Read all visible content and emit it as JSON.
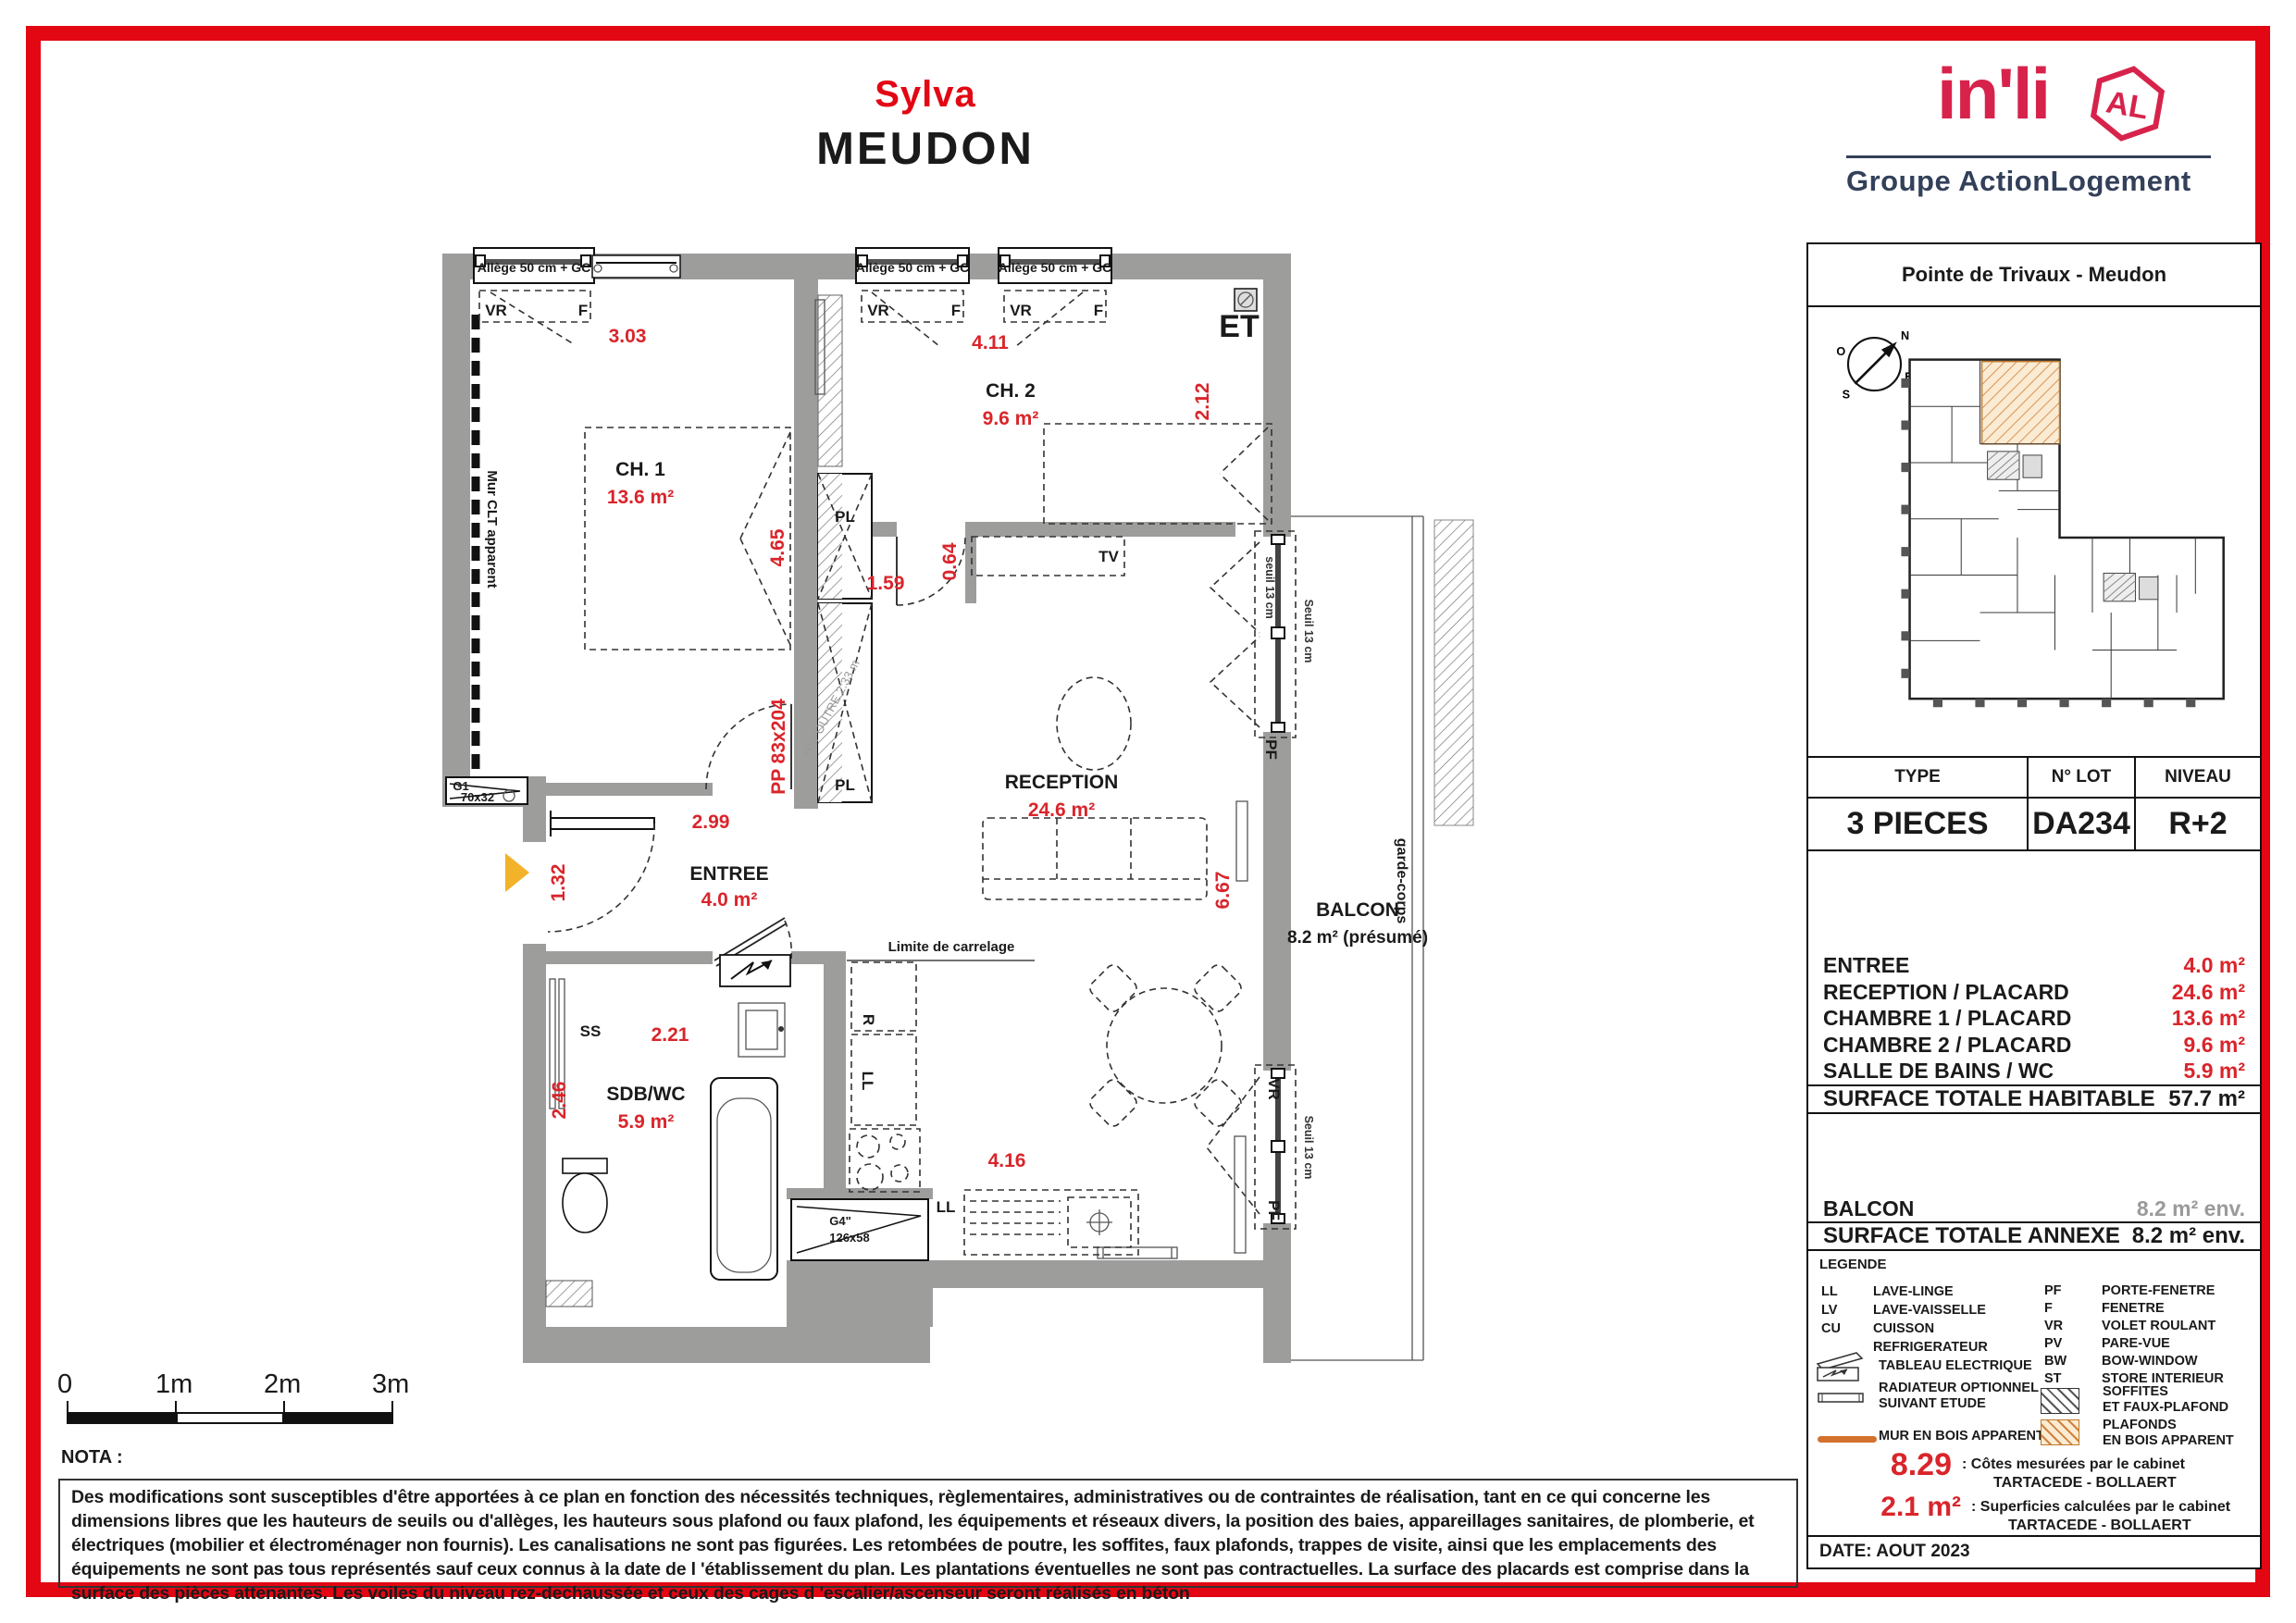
{
  "colors": {
    "frame_red": "#E30613",
    "accent_red": "#D9252B",
    "wall_gray": "#9D9D9C",
    "brand_red": "#D7234B",
    "brand_navy": "#33405A",
    "legend_orange": "#D2722E",
    "balcony_gray": "#8a8a8a",
    "entrance_yellow": "#F2B229"
  },
  "header": {
    "project": "Sylva",
    "city": "MEUDON"
  },
  "logo": {
    "brand": "in'li",
    "badge": "AL",
    "group": "Groupe ActionLogement"
  },
  "panel": {
    "project": "Pointe de Trivaux - Meudon",
    "compass": {
      "n": "N",
      "s": "S",
      "e": "E",
      "o": "O"
    },
    "lot_table": {
      "type_label": "TYPE",
      "type_value": "3 PIECES",
      "lot_label": "N° LOT",
      "lot_value": "DA234",
      "niveau_label": "NIVEAU",
      "niveau_value": "R+2"
    },
    "rooms": [
      {
        "label": "ENTREE",
        "value": "4.0 m²"
      },
      {
        "label": "RECEPTION / PLACARD",
        "value": "24.6 m²"
      },
      {
        "label": "CHAMBRE 1 / PLACARD",
        "value": "13.6 m²"
      },
      {
        "label": "CHAMBRE 2 / PLACARD",
        "value": "9.6 m²"
      },
      {
        "label": "SALLE DE BAINS / WC",
        "value": "5.9 m²"
      }
    ],
    "total": {
      "label": "SURFACE TOTALE HABITABLE",
      "value": "57.7 m²"
    },
    "balcon": {
      "label": "BALCON",
      "value": "8.2 m² env."
    },
    "annexe": {
      "label": "SURFACE TOTALE ANNEXE",
      "value": "8.2 m² env."
    },
    "legend": {
      "title": "LEGENDE",
      "col1": [
        {
          "abbr": "LL",
          "label": "LAVE-LINGE"
        },
        {
          "abbr": "LV",
          "label": "LAVE-VAISSELLE"
        },
        {
          "abbr": "CU",
          "label": "CUISSON"
        },
        {
          "abbr": "",
          "label": "REFRIGERATEUR"
        }
      ],
      "col2": [
        {
          "abbr": "PF",
          "label": "PORTE-FENETRE"
        },
        {
          "abbr": "F",
          "label": "FENETRE"
        },
        {
          "abbr": "VR",
          "label": "VOLET ROULANT"
        },
        {
          "abbr": "PV",
          "label": "PARE-VUE"
        },
        {
          "abbr": "BW",
          "label": "BOW-WINDOW"
        },
        {
          "abbr": "ST",
          "label": "STORE INTERIEUR"
        }
      ],
      "tableau": "TABLEAU ELECTRIQUE",
      "radiateur_1": "RADIATEUR OPTIONNEL",
      "radiateur_2": "SUIVANT ETUDE",
      "soffites_1": "SOFFITES",
      "soffites_2": "ET FAUX-PLAFOND",
      "mur_bois": "MUR EN BOIS APPARENT",
      "plafonds_1": "PLAFONDS",
      "plafonds_2": "EN BOIS APPARENT",
      "cotes_value": "8.29",
      "cotes_text": ": Côtes mesurées par le cabinet",
      "cotes_cabinet": "TARTACEDE - BOLLAERT",
      "sup_value": "2.1 m²",
      "sup_text": ": Superficies calculées par le cabinet",
      "sup_cabinet": "TARTACEDE - BOLLAERT"
    },
    "date": "DATE: AOUT 2023"
  },
  "plan": {
    "rooms": {
      "ch1": {
        "name": "CH. 1",
        "area": "13.6 m²"
      },
      "ch2": {
        "name": "CH. 2",
        "area": "9.6 m²"
      },
      "reception": {
        "name": "RECEPTION",
        "area": "24.6 m²"
      },
      "entree": {
        "name": "ENTREE",
        "area": "4.0 m²"
      },
      "sdb": {
        "name": "SDB/WC",
        "area": "5.9 m²"
      },
      "balcon": {
        "name": "BALCON",
        "area": "8.2 m² (présumé)"
      }
    },
    "dims": {
      "d303": "3.03",
      "d411": "4.11",
      "d212": "2.12",
      "d465": "4.65",
      "d159": "1.59",
      "d064": "0.64",
      "d299": "2.99",
      "d132": "1.32",
      "d221": "2.21",
      "d246": "2.46",
      "d416": "4.16",
      "d667": "6.67"
    },
    "labels": {
      "allege": "Allège 50 cm + GC",
      "vr": "VR",
      "f": "F",
      "pf": "PF",
      "pl": "PL",
      "tv": "TV",
      "ss": "SS",
      "r": "R",
      "ll": "LL",
      "mur_clt": "Mur CLT apparent",
      "pp": "PP 83x204",
      "hspoutre": "HSPOUTRE 2.33 m",
      "limite": "Limite de carrelage",
      "garde_corps": "garde-corps",
      "seuil": "Seuil 13 cm",
      "seuil_lc": "seuil 13 cm",
      "g1": "G1",
      "g1_size": "70x32",
      "g4": "G4\"",
      "g4_size": "126x58",
      "et": "ET"
    }
  },
  "scalebar": {
    "t0": "0",
    "t1": "1m",
    "t2": "2m",
    "t3": "3m"
  },
  "nota": {
    "label": "NOTA :",
    "text": "Des modifications sont susceptibles d'être apportées à ce plan en fonction des nécessités techniques, règlementaires, administratives ou de contraintes de réalisation, tant en ce qui concerne les dimensions libres que les hauteurs de seuils ou d'allèges, les hauteurs sous plafond ou faux plafond, les équipements et réseaux divers, la position des baies, appareillages sanitaires, de plomberie, et électriques (mobilier et électroménager non fournis). Les canalisations ne sont pas figurées. Les retombées de poutre, les soffites, faux plafonds, trappes de visite, ainsi que les emplacements des équipements ne sont pas tous représentés sauf ceux connus à la date de l 'établissement du plan. Les plantations éventuelles ne sont pas contractuelles. La surface des placards est comprise dans la surface des pièces attenantes. Les voiles du niveau rez-dechaussée et ceux des cages d 'escalier/ascenseur seront réalisés en béton"
  }
}
